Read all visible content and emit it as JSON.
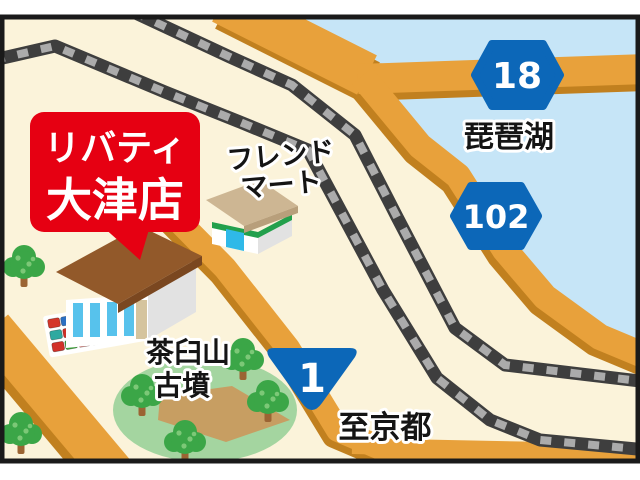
{
  "store_callout": {
    "line1": "リバティ",
    "line2": "大津店"
  },
  "places": {
    "friend_mart": {
      "line1": "フレンド",
      "line2": "マート"
    },
    "lake_biwa": "琵琶湖",
    "kofun": {
      "line1": "茶臼山",
      "line2": "古墳"
    },
    "to_kyoto": "至京都"
  },
  "route_shields": {
    "prefectural_18": "18",
    "prefectural_102": "102",
    "national_1": "1"
  },
  "parking": {
    "car_colors": [
      "#D4362A",
      "#2B6FC2",
      "#CF3128",
      "#2FA9A0",
      "#C8342B",
      "#3FA53C",
      "#E8E8E8",
      "#2FA9A0",
      "#CF3128",
      "#2B6FC2",
      "#D4362A",
      "#36B3AA",
      "#CB2F27",
      "#2B6FC2",
      "#D23129",
      "#3FA53C",
      "#CF3128",
      "#2B6FC2",
      "#CB2F27",
      "#2FA9A0",
      "#D4362A"
    ]
  },
  "theme": {
    "colors": {
      "background": "#FBF3DA",
      "lake": "#C6E5F7",
      "road": "#E8A13B",
      "road_shadow": "#C1801F",
      "rail": "#3E3E3E",
      "rail_tie": "#ABABAB",
      "sign_red": "#E60012",
      "shield_blue": "#0C67B8",
      "tree": "#3BA647",
      "tree_light": "#7CC877",
      "trunk": "#9B6433",
      "mound": "#A4D5A0",
      "mound_path": "#C79E62",
      "roof": "#92592A",
      "roof_edge": "#7A4720",
      "wall_side": "#E2E2E2",
      "window_blue": "#57C2EC",
      "door_beige": "#D5C49E",
      "fm_roof": "#CDB693",
      "fm_roof_edge": "#B89F7B",
      "fm_stripe": "#22A04C",
      "fm_door": "#2FB9E8",
      "label_ink": "#141414",
      "frame": "#1A1A1A"
    }
  }
}
